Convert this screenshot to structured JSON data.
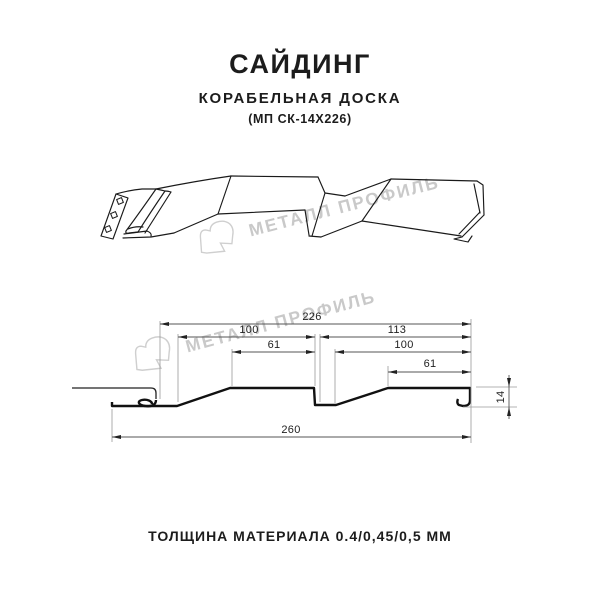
{
  "header": {
    "title": "САЙДИНГ",
    "subtitle": "КОРАБЕЛЬНАЯ ДОСКА",
    "model": "(МП СК-14Х226)"
  },
  "watermark": {
    "text": "МЕТАЛЛ ПРОФИЛЬ",
    "logo_icon": "metall-profil-logo",
    "color": "#c9c9c9"
  },
  "diagram": {
    "views": [
      "3d-profile-sketch",
      "cross-section-with-dimensions"
    ],
    "dims": {
      "d226": "226",
      "d100_left": "100",
      "d113": "113",
      "d61_left": "61",
      "d100_right": "100",
      "d61_right": "61",
      "d260": "260",
      "d14": "14"
    },
    "dimensions_mm": {
      "overall_width": "260",
      "module_width": "226",
      "board1_width": "100",
      "board1_flat": "61",
      "board2_width": "113",
      "board2_pitch": "100",
      "board2_flat": "61",
      "profile_depth": "14"
    }
  },
  "footer": {
    "thickness": "ТОЛЩИНА МАТЕРИАЛА 0.4/0,45/0,5 ММ"
  },
  "colors": {
    "line": "#1a1a1a",
    "profile": "#111111",
    "dim_line": "#555555",
    "ext_line": "#9a9a9a",
    "watermark": "#c9c9c9",
    "text": "#1c1c1c"
  }
}
